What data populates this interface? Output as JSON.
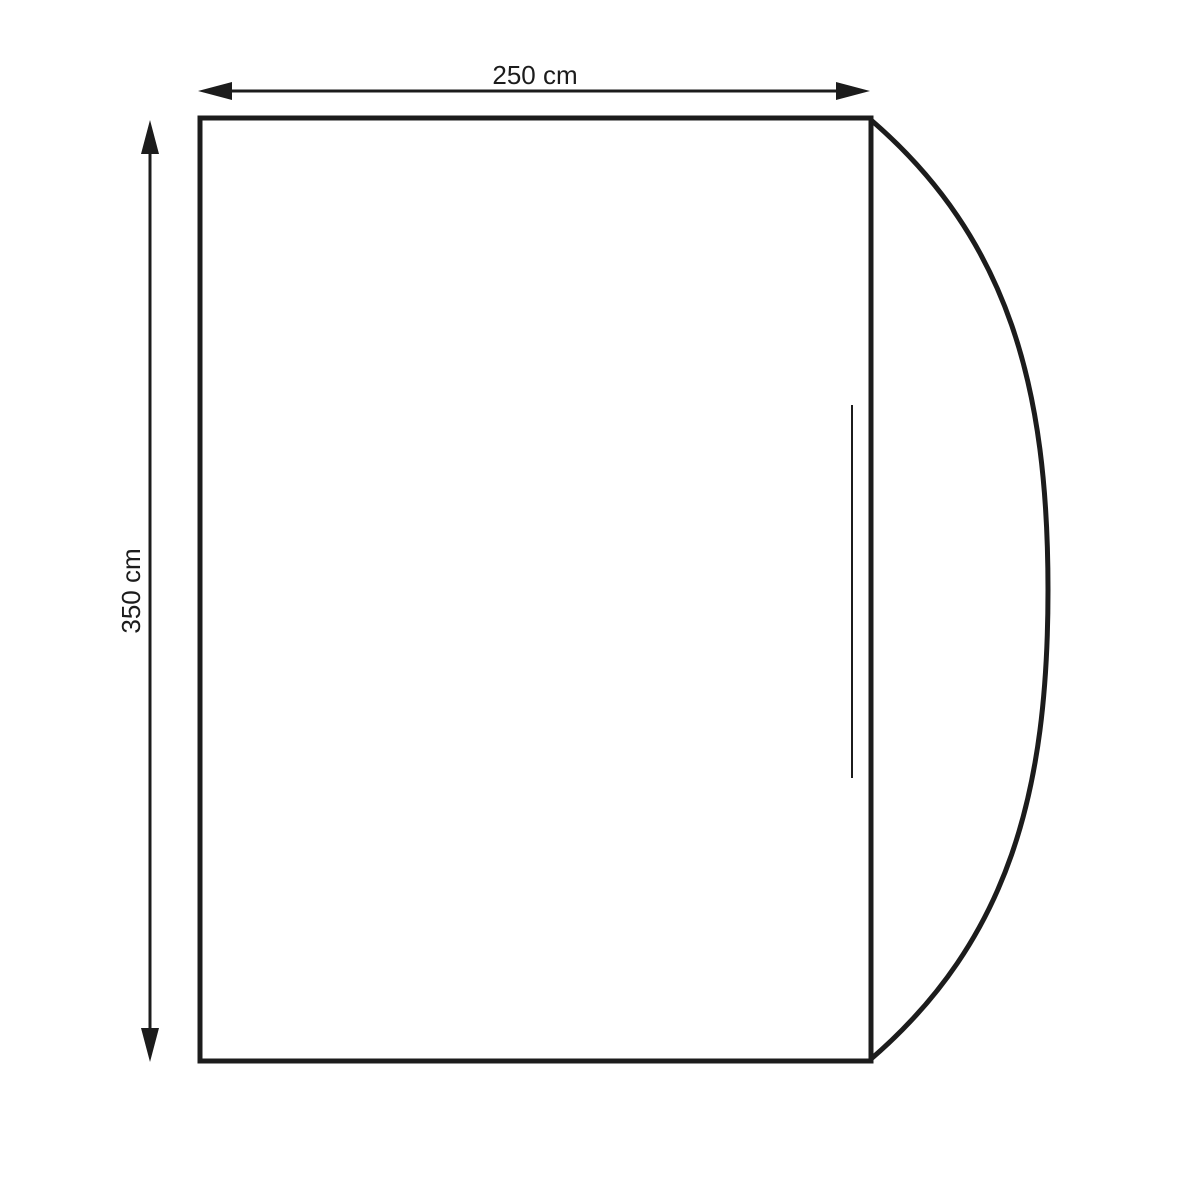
{
  "diagram": {
    "kind": "product-dimension-drawing",
    "dimensions": {
      "width": {
        "label": "250 cm",
        "value": 250,
        "unit": "cm"
      },
      "height": {
        "label": "350 cm",
        "value": 350,
        "unit": "cm"
      }
    }
  },
  "colors": {
    "ink": "#1c1c1c",
    "background": "#ffffff"
  }
}
